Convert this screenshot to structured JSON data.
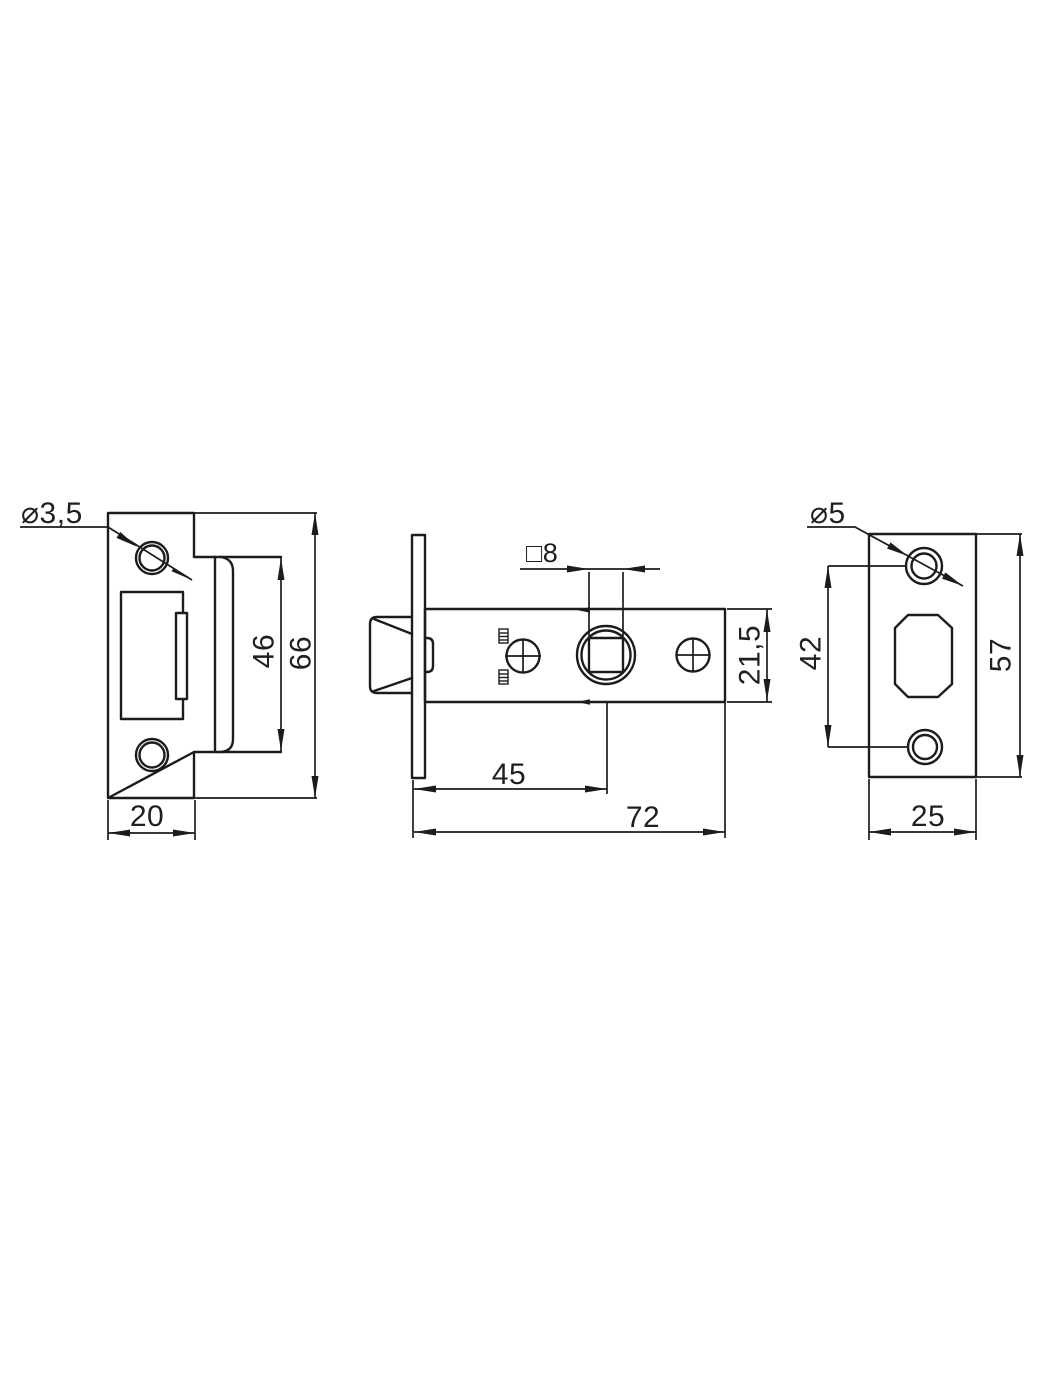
{
  "page": {
    "background": "#ffffff",
    "line_color": "#1c1c1c",
    "kind": "technical drawing, door latch with strike plate, three orthographic views"
  },
  "views": {
    "strike_plate": {
      "title": "strike plate front view",
      "dims": {
        "hole_dia": "⌀3,5",
        "lip_height": "46",
        "total_height": "66",
        "width": "20"
      }
    },
    "latch_body": {
      "title": "latch body side view",
      "dims": {
        "spindle_square": "□8",
        "body_height": "21,5",
        "backset": "45",
        "length": "72"
      }
    },
    "faceplate": {
      "title": "faceplate front view",
      "dims": {
        "hole_dia": "⌀5",
        "hole_spacing": "42",
        "height": "57",
        "width": "25"
      }
    }
  }
}
